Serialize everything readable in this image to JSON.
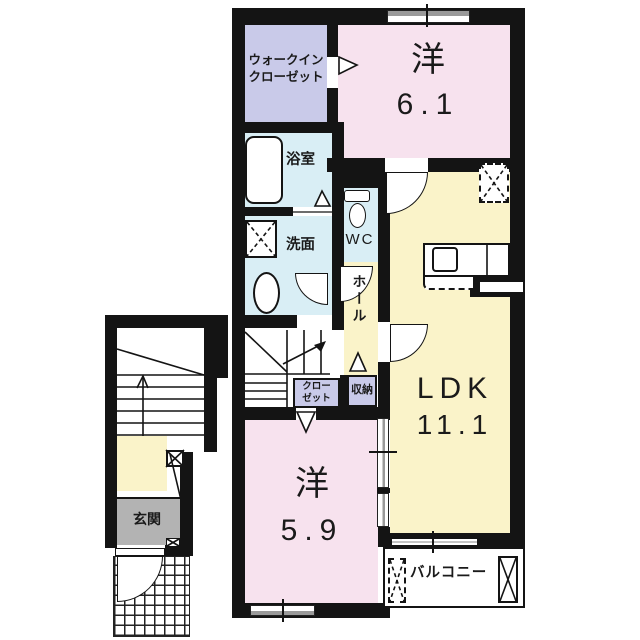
{
  "rooms": {
    "walk_in_closet": {
      "line1": "ウォークイン",
      "line2": "クローゼット"
    },
    "western_room_1": {
      "label": "洋",
      "size": "6.1"
    },
    "bathroom": {
      "label": "浴室"
    },
    "washroom": {
      "label": "洗面"
    },
    "toilet": {
      "label": "WC"
    },
    "hall": {
      "label": "ホール"
    },
    "closet": {
      "line1": "クロー",
      "line2": "ゼット"
    },
    "storage": {
      "label": "収納"
    },
    "ldk": {
      "label": "LDK",
      "size": "11.1"
    },
    "western_room_2": {
      "label": "洋",
      "size": "5.9"
    },
    "entrance": {
      "label": "玄関"
    },
    "balcony": {
      "label": "バルコニー"
    }
  },
  "colors": {
    "wall": "#141414",
    "room_pink": "#f7e2ee",
    "room_yellow": "#faf3c9",
    "room_lavender": "#c9cae9",
    "room_blue": "#d9eef5",
    "entrance_gray": "#b3b3b3",
    "background": "#ffffff"
  }
}
